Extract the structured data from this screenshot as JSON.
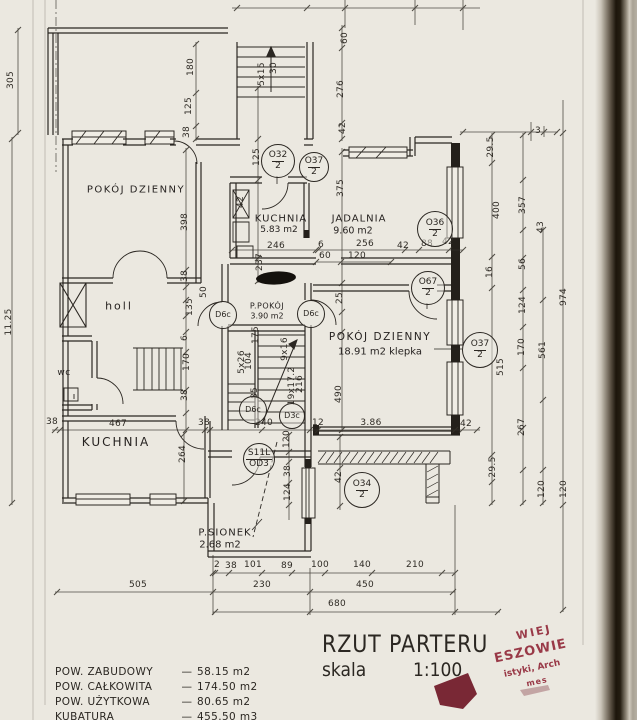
{
  "title_block": {
    "title": "RZUT PARTERU",
    "scale_label": "skala",
    "scale_value": "1:100"
  },
  "areas_table": [
    {
      "label": "POW. ZABUDOWY",
      "sep": "—",
      "value": "58.15 m2"
    },
    {
      "label": "POW. CAŁKOWITA",
      "sep": "—",
      "value": "174.50 m2"
    },
    {
      "label": "POW. UŻYTKOWA",
      "sep": "—",
      "value": "80.65 m2"
    },
    {
      "label": "KUBATURA",
      "sep": "—",
      "value": "455.50 m3"
    }
  ],
  "rooms": [
    {
      "name": "POKÓJ DZIENNY",
      "area": "",
      "nx": 136,
      "ny": 190,
      "ax": 0,
      "ay": 0,
      "fs": 10,
      "afs": 9,
      "ls": 1.5
    },
    {
      "name": "KUCHNIA",
      "area": "5.83 m2",
      "nx": 281,
      "ny": 219,
      "ax": 279,
      "ay": 230,
      "fs": 10,
      "afs": 9,
      "ls": 1
    },
    {
      "name": "JADALNIA",
      "area": "9.60 m2",
      "nx": 359,
      "ny": 219,
      "ax": 353,
      "ay": 231,
      "fs": 10,
      "afs": 9.5,
      "ls": 1
    },
    {
      "name": "holl",
      "area": "",
      "nx": 119,
      "ny": 306,
      "ax": 0,
      "ay": 0,
      "fs": 11,
      "afs": 9,
      "ls": 2
    },
    {
      "name": "wc",
      "area": "",
      "nx": 64,
      "ny": 373,
      "ax": 0,
      "ay": 0,
      "fs": 9,
      "afs": 8,
      "ls": 0.5
    },
    {
      "name": "KUCHNIA",
      "area": "",
      "nx": 116,
      "ny": 442,
      "ax": 0,
      "ay": 0,
      "fs": 12,
      "afs": 9,
      "ls": 2
    },
    {
      "name": "POKÓJ DZIENNY",
      "area": "18.91 m2 klepka",
      "nx": 380,
      "ny": 337,
      "ax": 380,
      "ay": 352,
      "fs": 10.5,
      "afs": 10,
      "ls": 1.5
    },
    {
      "name": "P.POKÓJ",
      "area": "3.90 m2",
      "nx": 267,
      "ny": 306,
      "ax": 267,
      "ay": 316,
      "fs": 8,
      "afs": 8,
      "ls": 0.5
    },
    {
      "name": "P.SIONEK",
      "area": "2.68 m2",
      "nx": 225,
      "ny": 533,
      "ax": 220,
      "ay": 545,
      "fs": 10,
      "afs": 10,
      "ls": 1
    }
  ],
  "symbols": [
    {
      "t": "O32",
      "b": "2",
      "x": 277,
      "y": 160,
      "r": 16
    },
    {
      "t": "O37",
      "b": "2",
      "x": 313,
      "y": 166,
      "r": 14
    },
    {
      "t": "O36",
      "b": "2",
      "x": 434,
      "y": 228,
      "r": 17
    },
    {
      "t": "O67",
      "b": "2",
      "x": 427,
      "y": 287,
      "r": 16
    },
    {
      "t": "D6c",
      "b": "",
      "x": 222,
      "y": 314,
      "r": 13
    },
    {
      "t": "D6c",
      "b": "",
      "x": 310,
      "y": 313,
      "r": 13
    },
    {
      "t": "O37",
      "b": "2",
      "x": 479,
      "y": 349,
      "r": 17
    },
    {
      "t": "D6c",
      "b": "",
      "x": 252,
      "y": 409,
      "r": 13
    },
    {
      "t": "D3c",
      "b": "",
      "x": 291,
      "y": 415,
      "r": 12
    },
    {
      "t": "S11L",
      "b": "OD3",
      "x": 258,
      "y": 458,
      "r": 15
    },
    {
      "t": "O34",
      "b": "2",
      "x": 361,
      "y": 489,
      "r": 17
    }
  ],
  "dimensions": [
    {
      "t": "305",
      "x": 11,
      "y": 80,
      "v": 1
    },
    {
      "t": "11.25",
      "x": 9,
      "y": 322,
      "v": 1
    },
    {
      "t": "180",
      "x": 191,
      "y": 67,
      "v": 1
    },
    {
      "t": "125",
      "x": 189,
      "y": 106,
      "v": 1
    },
    {
      "t": "38",
      "x": 187,
      "y": 132,
      "v": 1
    },
    {
      "t": "5x15",
      "x": 262,
      "y": 74,
      "v": 1
    },
    {
      "t": "30",
      "x": 274,
      "y": 68,
      "v": 1
    },
    {
      "t": "60",
      "x": 345,
      "y": 38,
      "v": 1
    },
    {
      "t": "276",
      "x": 341,
      "y": 89,
      "v": 1
    },
    {
      "t": "42",
      "x": 343,
      "y": 128,
      "v": 1
    },
    {
      "t": "125",
      "x": 257,
      "y": 157,
      "v": 1
    },
    {
      "t": "42",
      "x": 241,
      "y": 202,
      "v": 1
    },
    {
      "t": "398",
      "x": 185,
      "y": 222,
      "v": 1
    },
    {
      "t": "38",
      "x": 185,
      "y": 276,
      "v": 1
    },
    {
      "t": "50",
      "x": 204,
      "y": 292,
      "v": 1
    },
    {
      "t": "135",
      "x": 190,
      "y": 307,
      "v": 1
    },
    {
      "t": "375",
      "x": 341,
      "y": 188,
      "v": 1
    },
    {
      "t": "237",
      "x": 260,
      "y": 262,
      "v": 1
    },
    {
      "t": "29.5",
      "x": 491,
      "y": 147,
      "v": 1
    },
    {
      "t": "400",
      "x": 497,
      "y": 210,
      "v": 1
    },
    {
      "t": "357",
      "x": 523,
      "y": 205,
      "v": 1
    },
    {
      "t": "43",
      "x": 541,
      "y": 227,
      "v": 1
    },
    {
      "t": "16",
      "x": 490,
      "y": 272,
      "v": 1
    },
    {
      "t": "56",
      "x": 523,
      "y": 264,
      "v": 1
    },
    {
      "t": "124",
      "x": 523,
      "y": 305,
      "v": 1
    },
    {
      "t": "974",
      "x": 564,
      "y": 297,
      "v": 1
    },
    {
      "t": "170",
      "x": 522,
      "y": 347,
      "v": 1
    },
    {
      "t": "561",
      "x": 543,
      "y": 350,
      "v": 1
    },
    {
      "t": "515",
      "x": 501,
      "y": 367,
      "v": 1
    },
    {
      "t": "25",
      "x": 340,
      "y": 298,
      "v": 1
    },
    {
      "t": "490",
      "x": 339,
      "y": 394,
      "v": 1
    },
    {
      "t": "6",
      "x": 185,
      "y": 338,
      "v": 1
    },
    {
      "t": "170",
      "x": 187,
      "y": 362,
      "v": 1
    },
    {
      "t": "38",
      "x": 185,
      "y": 395,
      "v": 1
    },
    {
      "t": "175",
      "x": 256,
      "y": 335,
      "v": 1
    },
    {
      "t": "104",
      "x": 249,
      "y": 361,
      "v": 1
    },
    {
      "t": "5x26",
      "x": 242,
      "y": 362,
      "v": 1
    },
    {
      "t": "85",
      "x": 255,
      "y": 393,
      "v": 1
    },
    {
      "t": "9x16",
      "x": 285,
      "y": 349,
      "v": 1
    },
    {
      "t": "19x17.2",
      "x": 292,
      "y": 386,
      "v": 1
    },
    {
      "t": "216",
      "x": 300,
      "y": 384,
      "v": 1
    },
    {
      "t": "264",
      "x": 183,
      "y": 454,
      "v": 1
    },
    {
      "t": "120",
      "x": 287,
      "y": 439,
      "v": 1
    },
    {
      "t": "38",
      "x": 288,
      "y": 471,
      "v": 1
    },
    {
      "t": "124",
      "x": 288,
      "y": 492,
      "v": 1
    },
    {
      "t": "42",
      "x": 339,
      "y": 477,
      "v": 1
    },
    {
      "t": "29.5",
      "x": 493,
      "y": 467,
      "v": 1
    },
    {
      "t": "267",
      "x": 522,
      "y": 427,
      "v": 1
    },
    {
      "t": "120",
      "x": 542,
      "y": 489,
      "v": 1
    },
    {
      "t": "120",
      "x": 564,
      "y": 489,
      "v": 1
    },
    {
      "t": "246",
      "x": 276,
      "y": 246,
      "v": 0
    },
    {
      "t": "6",
      "x": 321,
      "y": 245,
      "v": 0
    },
    {
      "t": "256",
      "x": 365,
      "y": 244,
      "v": 0
    },
    {
      "t": "42",
      "x": 403,
      "y": 246,
      "v": 0
    },
    {
      "t": "88",
      "x": 427,
      "y": 244,
      "v": 0
    },
    {
      "t": "42",
      "x": 448,
      "y": 242,
      "v": 0
    },
    {
      "t": "60",
      "x": 325,
      "y": 256,
      "v": 0
    },
    {
      "t": "120",
      "x": 357,
      "y": 256,
      "v": 0
    },
    {
      "t": "3",
      "x": 538,
      "y": 131,
      "v": 0
    },
    {
      "t": "12",
      "x": 318,
      "y": 423,
      "v": 0
    },
    {
      "t": "3.86",
      "x": 371,
      "y": 423,
      "v": 0
    },
    {
      "t": "42",
      "x": 466,
      "y": 424,
      "v": 0
    },
    {
      "t": "38",
      "x": 52,
      "y": 422,
      "v": 0
    },
    {
      "t": "467",
      "x": 118,
      "y": 424,
      "v": 0
    },
    {
      "t": "38",
      "x": 204,
      "y": 423,
      "v": 0
    },
    {
      "t": "240",
      "x": 264,
      "y": 423,
      "v": 0
    },
    {
      "t": "2",
      "x": 217,
      "y": 565,
      "v": 0
    },
    {
      "t": "38",
      "x": 231,
      "y": 566,
      "v": 0
    },
    {
      "t": "101",
      "x": 253,
      "y": 565,
      "v": 0
    },
    {
      "t": "89",
      "x": 287,
      "y": 566,
      "v": 0
    },
    {
      "t": "100",
      "x": 320,
      "y": 565,
      "v": 0
    },
    {
      "t": "140",
      "x": 362,
      "y": 565,
      "v": 0
    },
    {
      "t": "210",
      "x": 415,
      "y": 565,
      "v": 0
    },
    {
      "t": "505",
      "x": 138,
      "y": 585,
      "v": 0
    },
    {
      "t": "230",
      "x": 262,
      "y": 585,
      "v": 0
    },
    {
      "t": "450",
      "x": 365,
      "y": 585,
      "v": 0
    },
    {
      "t": "680",
      "x": 337,
      "y": 604,
      "v": 0
    }
  ],
  "stamp": {
    "l1": "WIEJ",
    "l2": "ESZOWIE",
    "l3": "istyki, Arch",
    "l4": "mes"
  },
  "colors": {
    "ink": "#2b2722",
    "paper": "#ebe8e0",
    "stamp": "#8e2133"
  }
}
